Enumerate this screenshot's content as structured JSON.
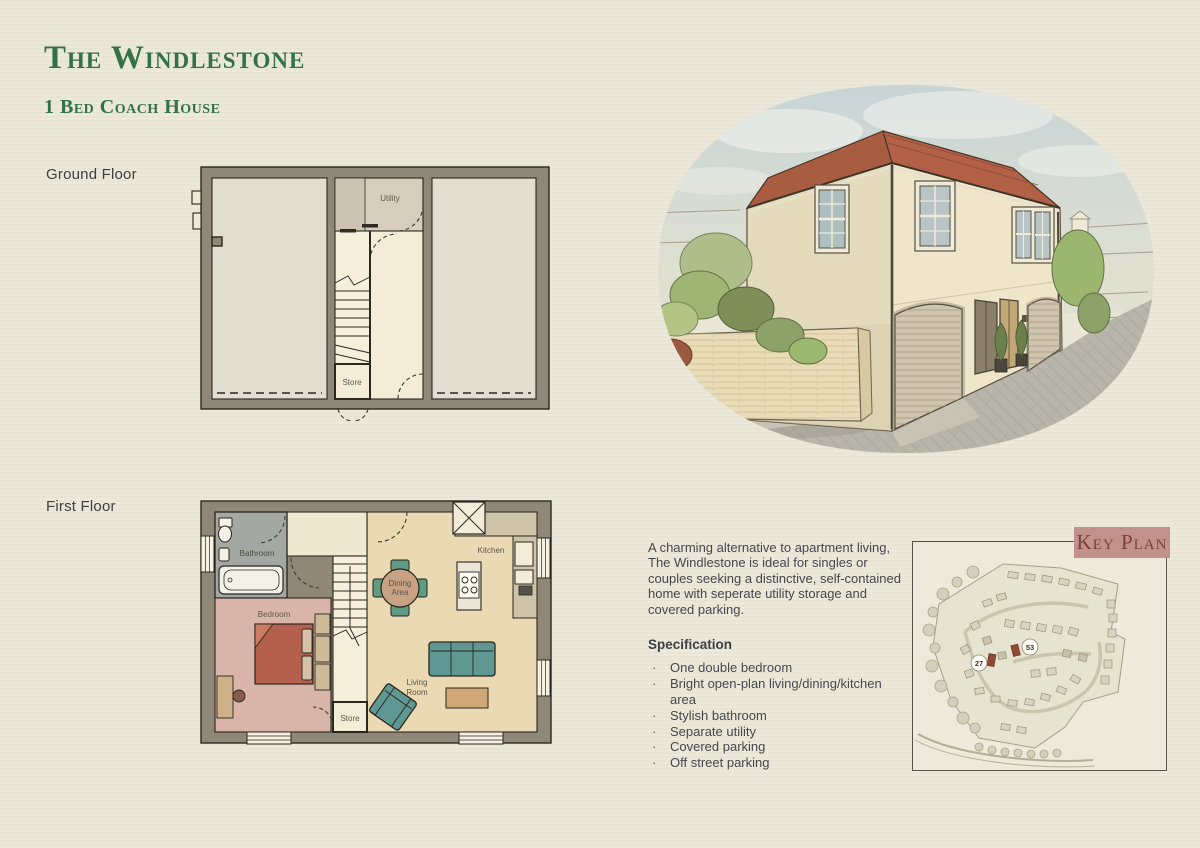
{
  "header": {
    "title": "The Windlestone",
    "subtitle": "1 Bed Coach House"
  },
  "ground_floor": {
    "label": "Ground Floor",
    "utility": "Utility",
    "store": "Store"
  },
  "first_floor": {
    "label": "First Floor",
    "bathroom": "Bathroom",
    "bedroom": "Bedroom",
    "kitchen": "Kitchen",
    "dining_line1": "Dining",
    "dining_line2": "Area",
    "living_line1": "Living",
    "living_line2": "Room",
    "store": "Store"
  },
  "description": "A charming alternative to apartment living, The Windlestone is ideal for singles or couples seeking a distinctive, self-contained home with seperate utility storage and covered parking.",
  "specification": {
    "heading": "Specification",
    "items": [
      "One double bedroom",
      "Bright open-plan living/dining/kitchen area",
      "Stylish bathroom",
      "Separate utility",
      "Covered parking",
      "Off street parking"
    ]
  },
  "key_plan": {
    "heading": "Key Plan",
    "plots": [
      "27",
      "53"
    ]
  },
  "colors": {
    "title_green": "#33714a",
    "page_background": "#ece8d9",
    "plan_wall": "#8f8878",
    "roof_terracotta": "#ad5f43",
    "key_plan_banner": "#c2918c",
    "key_plan_text": "#7c3f39",
    "sofa_teal": "#5f9793",
    "bed_terracotta": "#b5604d"
  }
}
